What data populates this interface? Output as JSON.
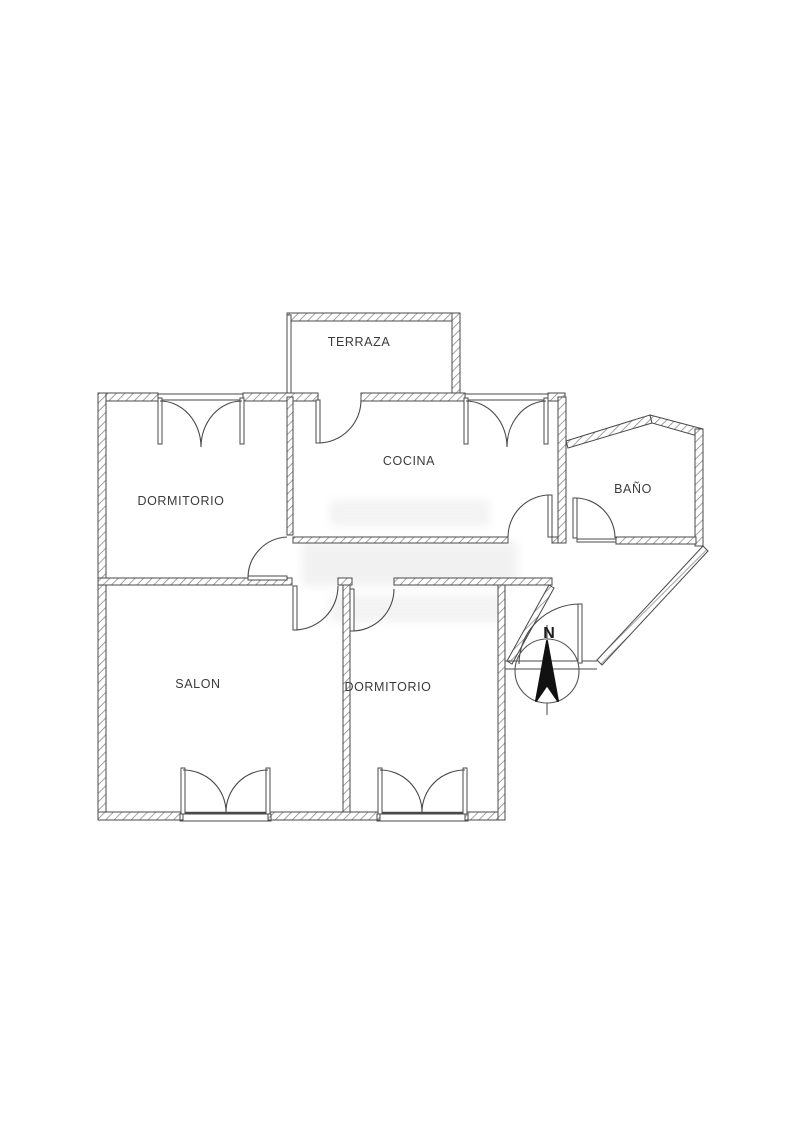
{
  "plan": {
    "rooms": [
      {
        "id": "terraza",
        "label": "TERRAZA"
      },
      {
        "id": "dormitorio-1",
        "label": "DORMITORIO"
      },
      {
        "id": "cocina",
        "label": "COCINA"
      },
      {
        "id": "bano",
        "label": "BAÑO"
      },
      {
        "id": "salon",
        "label": "SALON"
      },
      {
        "id": "dormitorio-2",
        "label": "DORMITORIO"
      }
    ],
    "compass": {
      "north_label": "N"
    },
    "colors": {
      "background": "#ffffff",
      "wall_outline": "#4a4a4a",
      "hatch": "#888888",
      "label_text": "#3b3b3b",
      "compass_needle": "#111111"
    }
  }
}
